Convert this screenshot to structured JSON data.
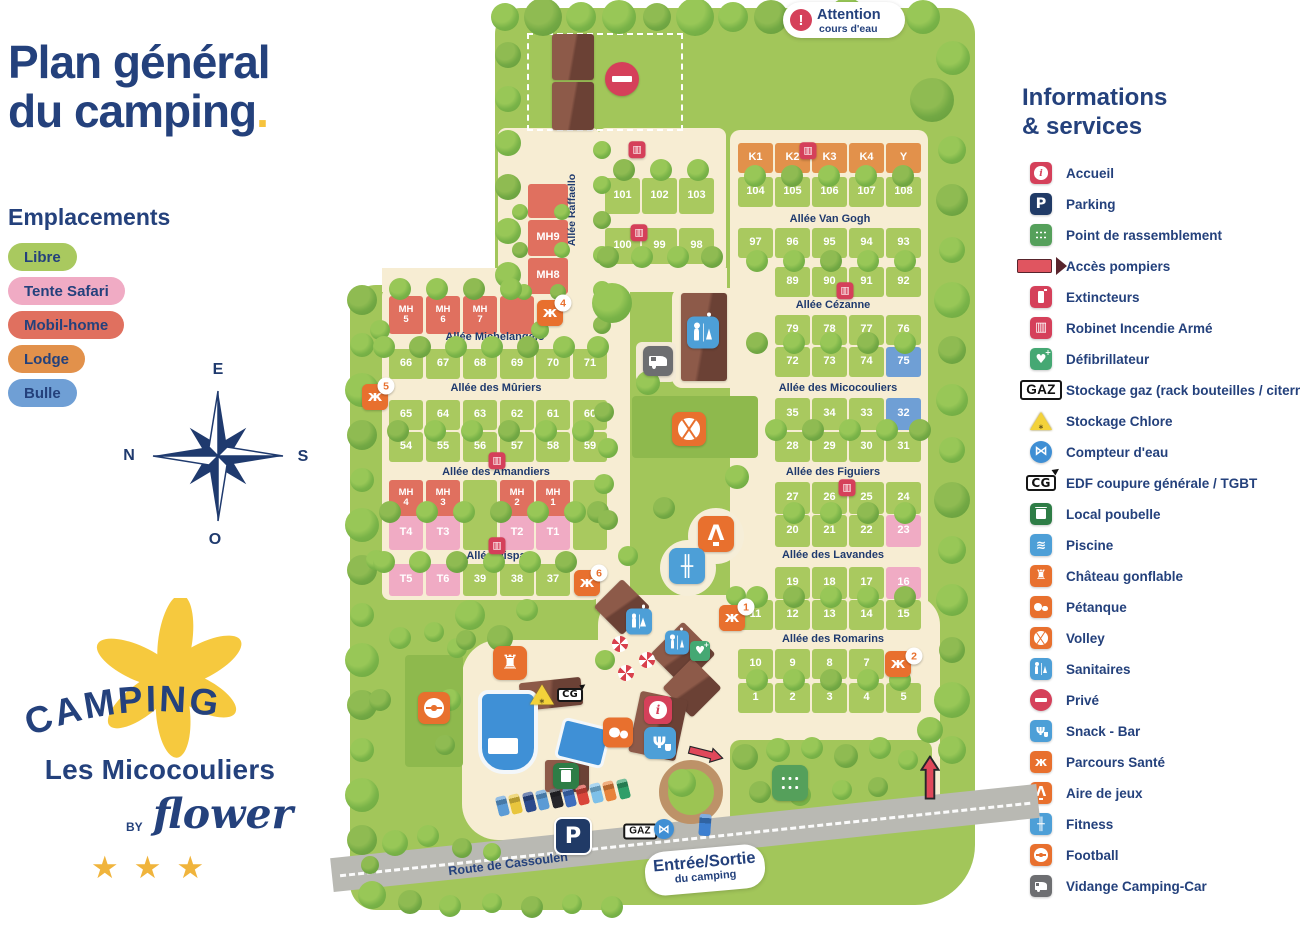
{
  "title": {
    "line1": "Plan général",
    "line2": "du camping",
    "accent_dot": "."
  },
  "legend": {
    "heading": "Emplacements",
    "items": [
      {
        "id": "libre",
        "label": "Libre",
        "color": "#a9c95f"
      },
      {
        "id": "safari",
        "label": "Tente Safari",
        "color": "#f0abc4"
      },
      {
        "id": "mobil",
        "label": "Mobil-home",
        "color": "#e0705f"
      },
      {
        "id": "lodge",
        "label": "Lodge",
        "color": "#e2914b"
      },
      {
        "id": "bulle",
        "label": "Bulle",
        "color": "#6f9fd5"
      }
    ]
  },
  "compass": {
    "top": "E",
    "left": "N",
    "right": "S",
    "bottom": "O"
  },
  "logo": {
    "word": "CAMPING",
    "name": "Les Micocouliers",
    "by": "BY",
    "brand": "flower",
    "stars": "★★★"
  },
  "sidebar": {
    "heading_line1": "Informations",
    "heading_line2": "& services",
    "items": [
      {
        "icon": "accueil",
        "label": "Accueil"
      },
      {
        "icon": "parking",
        "label": "Parking"
      },
      {
        "icon": "rassemblement",
        "label": "Point de rassemblement"
      },
      {
        "icon": "pompiers",
        "label": "Accès pompiers"
      },
      {
        "icon": "extincteurs",
        "label": "Extincteurs"
      },
      {
        "icon": "ria",
        "label": "Robinet Incendie Armé"
      },
      {
        "icon": "defib",
        "label": "Défibrillateur"
      },
      {
        "icon": "gaz",
        "label": "Stockage gaz (rack bouteilles / citernes)"
      },
      {
        "icon": "chlore",
        "label": "Stockage Chlore"
      },
      {
        "icon": "compteur",
        "label": "Compteur d'eau"
      },
      {
        "icon": "cg",
        "label": "EDF coupure générale / TGBT"
      },
      {
        "icon": "poubelle",
        "label": "Local poubelle"
      },
      {
        "icon": "piscine",
        "label": "Piscine"
      },
      {
        "icon": "chateau",
        "label": "Château gonflable"
      },
      {
        "icon": "petanque",
        "label": "Pétanque"
      },
      {
        "icon": "volley",
        "label": "Volley"
      },
      {
        "icon": "sanitaires",
        "label": "Sanitaires"
      },
      {
        "icon": "prive",
        "label": "Privé"
      },
      {
        "icon": "snack",
        "label": "Snack - Bar"
      },
      {
        "icon": "parcours",
        "label": "Parcours Santé"
      },
      {
        "icon": "jeux",
        "label": "Aire de jeux"
      },
      {
        "icon": "fitness",
        "label": "Fitness"
      },
      {
        "icon": "football",
        "label": "Football"
      },
      {
        "icon": "vidange",
        "label": "Vidange Camping-Car"
      }
    ]
  },
  "map": {
    "attention": {
      "title": "Attention",
      "subtitle": "cours d'eau"
    },
    "entrance": {
      "title": "Entrée/Sortie",
      "subtitle": "du camping"
    },
    "road_label": "Route de Cassoulen",
    "vertical_street": "Allée Raffaello",
    "icon_texts": {
      "gaz": "GAZ",
      "cg": "CG"
    },
    "alleys": [
      {
        "label": "Allée Van Gogh",
        "x": 830,
        "y": 219
      },
      {
        "label": "Allée Cézanne",
        "x": 833,
        "y": 305
      },
      {
        "label": "Allée des Micocouliers",
        "x": 838,
        "y": 388
      },
      {
        "label": "Allée des Figuiers",
        "x": 833,
        "y": 472
      },
      {
        "label": "Allée des Lavandes",
        "x": 833,
        "y": 555
      },
      {
        "label": "Allée des Romarins",
        "x": 833,
        "y": 639
      },
      {
        "label": "Allée Michelangelo",
        "x": 495,
        "y": 337
      },
      {
        "label": "Allée des Mûriers",
        "x": 496,
        "y": 388
      },
      {
        "label": "Allée des Amandiers",
        "x": 496,
        "y": 472
      },
      {
        "label": "Allée Hispa",
        "x": 496,
        "y": 556
      }
    ],
    "plot_rows": [
      {
        "y": 143,
        "h": 30,
        "w": 35,
        "t": "lodge",
        "cells": [
          {
            "n": "K1",
            "x": 738
          },
          {
            "n": "K2",
            "x": 775
          },
          {
            "n": "K3",
            "x": 812
          },
          {
            "n": "K4",
            "x": 849
          },
          {
            "n": "Y",
            "x": 886
          }
        ]
      },
      {
        "y": 177,
        "h": 30,
        "w": 35,
        "t": "libre",
        "cells": [
          {
            "n": "104",
            "x": 738
          },
          {
            "n": "105",
            "x": 775
          },
          {
            "n": "106",
            "x": 812
          },
          {
            "n": "107",
            "x": 849
          },
          {
            "n": "108",
            "x": 886
          }
        ]
      },
      {
        "y": 228,
        "h": 30,
        "w": 35,
        "t": "libre",
        "cells": [
          {
            "n": "97",
            "x": 738
          },
          {
            "n": "96",
            "x": 775
          },
          {
            "n": "95",
            "x": 812
          },
          {
            "n": "94",
            "x": 849
          },
          {
            "n": "93",
            "x": 886
          }
        ]
      },
      {
        "y": 267,
        "h": 30,
        "w": 35,
        "t": "libre",
        "cells": [
          {
            "n": "89",
            "x": 775
          },
          {
            "n": "90",
            "x": 812
          },
          {
            "n": "91",
            "x": 849
          },
          {
            "n": "92",
            "x": 886
          }
        ]
      },
      {
        "y": 315,
        "h": 30,
        "w": 35,
        "t": "libre",
        "cells": [
          {
            "n": "79",
            "x": 775
          },
          {
            "n": "78",
            "x": 812
          },
          {
            "n": "77",
            "x": 849
          },
          {
            "n": "76",
            "x": 886
          }
        ]
      },
      {
        "y": 347,
        "h": 30,
        "w": 35,
        "t": "libre",
        "cells": [
          {
            "n": "72",
            "x": 775
          },
          {
            "n": "73",
            "x": 812
          },
          {
            "n": "74",
            "x": 849
          },
          {
            "n": "75",
            "x": 886,
            "t": "bulle"
          }
        ]
      },
      {
        "y": 398,
        "h": 32,
        "w": 35,
        "t": "libre",
        "cells": [
          {
            "n": "35",
            "x": 775
          },
          {
            "n": "34",
            "x": 812
          },
          {
            "n": "33",
            "x": 849
          },
          {
            "n": "32",
            "x": 886,
            "t": "bulle"
          }
        ]
      },
      {
        "y": 432,
        "h": 30,
        "w": 35,
        "t": "libre",
        "cells": [
          {
            "n": "28",
            "x": 775
          },
          {
            "n": "29",
            "x": 812
          },
          {
            "n": "30",
            "x": 849
          },
          {
            "n": "31",
            "x": 886
          }
        ]
      },
      {
        "y": 482,
        "h": 32,
        "w": 35,
        "t": "libre",
        "cells": [
          {
            "n": "27",
            "x": 775
          },
          {
            "n": "26",
            "x": 812
          },
          {
            "n": "25",
            "x": 849
          },
          {
            "n": "24",
            "x": 886
          }
        ]
      },
      {
        "y": 515,
        "h": 32,
        "w": 35,
        "t": "libre",
        "cells": [
          {
            "n": "20",
            "x": 775
          },
          {
            "n": "21",
            "x": 812
          },
          {
            "n": "22",
            "x": 849
          },
          {
            "n": "23",
            "x": 886,
            "t": "safari"
          }
        ]
      },
      {
        "y": 567,
        "h": 32,
        "w": 35,
        "t": "libre",
        "cells": [
          {
            "n": "19",
            "x": 775
          },
          {
            "n": "18",
            "x": 812
          },
          {
            "n": "17",
            "x": 849
          },
          {
            "n": "16",
            "x": 886,
            "t": "safari"
          }
        ]
      },
      {
        "y": 600,
        "h": 30,
        "w": 35,
        "t": "libre",
        "cells": [
          {
            "n": "11",
            "x": 738
          },
          {
            "n": "12",
            "x": 775
          },
          {
            "n": "13",
            "x": 812
          },
          {
            "n": "14",
            "x": 849
          },
          {
            "n": "15",
            "x": 886
          }
        ]
      },
      {
        "y": 649,
        "h": 30,
        "w": 35,
        "t": "libre",
        "cells": [
          {
            "n": "10",
            "x": 738
          },
          {
            "n": "9",
            "x": 775
          },
          {
            "n": "8",
            "x": 812
          },
          {
            "n": "7",
            "x": 849
          }
        ]
      },
      {
        "y": 683,
        "h": 30,
        "w": 35,
        "t": "libre",
        "cells": [
          {
            "n": "1",
            "x": 738
          },
          {
            "n": "2",
            "x": 775
          },
          {
            "n": "3",
            "x": 812
          },
          {
            "n": "4",
            "x": 849
          },
          {
            "n": "5",
            "x": 886
          }
        ]
      },
      {
        "y": 178,
        "h": 36,
        "w": 35,
        "t": "libre",
        "cells": [
          {
            "n": "101",
            "x": 605
          },
          {
            "n": "102",
            "x": 642
          },
          {
            "n": "103",
            "x": 679
          }
        ]
      },
      {
        "y": 228,
        "h": 36,
        "w": 35,
        "t": "libre",
        "cells": [
          {
            "n": "100",
            "x": 605
          },
          {
            "n": "99",
            "x": 642
          },
          {
            "n": "98",
            "x": 679
          }
        ]
      },
      {
        "y": 296,
        "h": 38,
        "w": 34,
        "t": "mobil",
        "split": true,
        "cells": [
          {
            "n": "MH5",
            "x": 389
          },
          {
            "n": "MH6",
            "x": 426
          },
          {
            "n": "MH7",
            "x": 463
          },
          {
            "n": "",
            "x": 500
          }
        ]
      },
      {
        "y": 349,
        "h": 30,
        "w": 34,
        "t": "libre",
        "cells": [
          {
            "n": "66",
            "x": 389
          },
          {
            "n": "67",
            "x": 426
          },
          {
            "n": "68",
            "x": 463
          },
          {
            "n": "69",
            "x": 500
          },
          {
            "n": "70",
            "x": 536
          },
          {
            "n": "71",
            "x": 573
          }
        ]
      },
      {
        "y": 400,
        "h": 30,
        "w": 34,
        "t": "libre",
        "cells": [
          {
            "n": "65",
            "x": 389
          },
          {
            "n": "64",
            "x": 426
          },
          {
            "n": "63",
            "x": 463
          },
          {
            "n": "62",
            "x": 500
          },
          {
            "n": "61",
            "x": 536
          },
          {
            "n": "60",
            "x": 573
          }
        ]
      },
      {
        "y": 432,
        "h": 30,
        "w": 34,
        "t": "libre",
        "cells": [
          {
            "n": "54",
            "x": 389
          },
          {
            "n": "55",
            "x": 426
          },
          {
            "n": "56",
            "x": 463
          },
          {
            "n": "57",
            "x": 500
          },
          {
            "n": "58",
            "x": 536
          },
          {
            "n": "59",
            "x": 573
          }
        ]
      },
      {
        "y": 480,
        "h": 36,
        "w": 34,
        "t": "mobil",
        "split": true,
        "cells": [
          {
            "n": "MH4",
            "x": 389
          },
          {
            "n": "MH3",
            "x": 426
          },
          {
            "n": "",
            "x": 463,
            "t": "libre"
          },
          {
            "n": "MH2",
            "x": 500
          },
          {
            "n": "MH1",
            "x": 536
          },
          {
            "n": "",
            "x": 573,
            "t": "libre"
          }
        ]
      },
      {
        "y": 516,
        "h": 34,
        "w": 34,
        "t": "safari",
        "cells": [
          {
            "n": "T4",
            "x": 389
          },
          {
            "n": "T3",
            "x": 426
          },
          {
            "n": "",
            "x": 463,
            "t": "libre"
          },
          {
            "n": "T2",
            "x": 500
          },
          {
            "n": "T1",
            "x": 536
          },
          {
            "n": "",
            "x": 573,
            "t": "libre"
          }
        ]
      },
      {
        "y": 564,
        "h": 32,
        "w": 34,
        "t": "libre",
        "cells": [
          {
            "n": "T5",
            "x": 389,
            "t": "safari"
          },
          {
            "n": "T6",
            "x": 426,
            "t": "safari"
          },
          {
            "n": "39",
            "x": 463
          },
          {
            "n": "38",
            "x": 500
          },
          {
            "n": "37",
            "x": 536
          }
        ]
      },
      {
        "y": 184,
        "h": 34,
        "w": 40,
        "t": "mobil",
        "cells": [
          {
            "n": "",
            "x": 528
          }
        ]
      },
      {
        "y": 220,
        "h": 36,
        "w": 40,
        "t": "mobil",
        "cells": [
          {
            "n": "MH9",
            "x": 528
          }
        ]
      },
      {
        "y": 258,
        "h": 36,
        "w": 40,
        "t": "mobil",
        "cells": [
          {
            "n": "MH8",
            "x": 528
          }
        ]
      }
    ],
    "parcours_badges": [
      {
        "n": "1",
        "x": 746,
        "y": 607
      },
      {
        "n": "2",
        "x": 914,
        "y": 656
      },
      {
        "n": "4",
        "x": 563,
        "y": 303
      },
      {
        "n": "5",
        "x": 386,
        "y": 386
      },
      {
        "n": "6",
        "x": 599,
        "y": 573
      }
    ],
    "icons": [
      {
        "t": "ria",
        "x": 637,
        "y": 149,
        "s": 17
      },
      {
        "t": "ria",
        "x": 808,
        "y": 150,
        "s": 17
      },
      {
        "t": "ria",
        "x": 639,
        "y": 232,
        "s": 17
      },
      {
        "t": "ria",
        "x": 845,
        "y": 290,
        "s": 17
      },
      {
        "t": "ria",
        "x": 847,
        "y": 487,
        "s": 17
      },
      {
        "t": "ria",
        "x": 497,
        "y": 460,
        "s": 17
      },
      {
        "t": "ria",
        "x": 497,
        "y": 545,
        "s": 17
      },
      {
        "t": "parcours",
        "x": 550,
        "y": 313,
        "s": 26
      },
      {
        "t": "parcours",
        "x": 375,
        "y": 397,
        "s": 26
      },
      {
        "t": "parcours",
        "x": 587,
        "y": 583,
        "s": 26
      },
      {
        "t": "parcours",
        "x": 732,
        "y": 618,
        "s": 26
      },
      {
        "t": "parcours",
        "x": 898,
        "y": 664,
        "s": 26
      },
      {
        "t": "sanitaires",
        "x": 703,
        "y": 335,
        "s": 32
      },
      {
        "t": "sanitaires",
        "x": 639,
        "y": 624,
        "s": 26
      },
      {
        "t": "sanitaires",
        "x": 677,
        "y": 645,
        "s": 24
      },
      {
        "t": "defib",
        "x": 700,
        "y": 651,
        "s": 20
      },
      {
        "t": "vidange",
        "x": 658,
        "y": 361,
        "s": 30
      },
      {
        "t": "volley",
        "x": 689,
        "y": 429,
        "s": 34
      },
      {
        "t": "football",
        "x": 434,
        "y": 708,
        "s": 32
      },
      {
        "t": "jeux",
        "x": 716,
        "y": 534,
        "s": 36
      },
      {
        "t": "fitness",
        "x": 687,
        "y": 566,
        "s": 36
      },
      {
        "t": "chateau",
        "x": 510,
        "y": 663,
        "s": 34
      },
      {
        "t": "chlore",
        "x": 542,
        "y": 696,
        "s": 24
      },
      {
        "t": "cg",
        "x": 570,
        "y": 694,
        "s": 18
      },
      {
        "t": "petanque",
        "x": 618,
        "y": 735,
        "s": 30
      },
      {
        "t": "accueil",
        "x": 658,
        "y": 710,
        "s": 28
      },
      {
        "t": "snack",
        "x": 660,
        "y": 743,
        "s": 32
      },
      {
        "t": "poubelle",
        "x": 566,
        "y": 776,
        "s": 26
      },
      {
        "t": "parking",
        "x": 573,
        "y": 836,
        "s": 34
      },
      {
        "t": "gaz",
        "x": 640,
        "y": 830,
        "s": 16
      },
      {
        "t": "compteur",
        "x": 664,
        "y": 829,
        "s": 20
      },
      {
        "t": "rassemblement",
        "x": 790,
        "y": 783,
        "s": 36
      },
      {
        "t": "noentry",
        "x": 622,
        "y": 79,
        "s": 34
      },
      {
        "t": "arrow-right",
        "x": 706,
        "y": 751,
        "s": 36
      },
      {
        "t": "arrow-up",
        "x": 930,
        "y": 783,
        "s": 44
      }
    ]
  }
}
